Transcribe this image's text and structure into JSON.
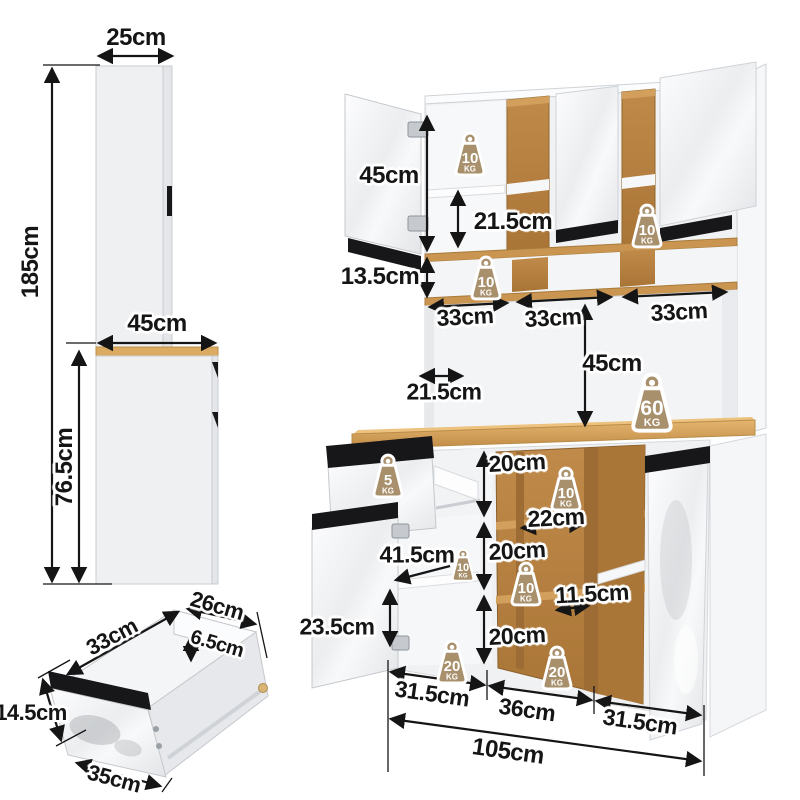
{
  "colors": {
    "oak": "#b5813f",
    "oak_light": "#d2a05c",
    "oak_dark": "#9c6c34",
    "countertop": "#dcab63",
    "panel_white": "#f2f3f5",
    "handle_black": "#17171a",
    "weight_badge": "#a8906c",
    "dimension_text": "#151515"
  },
  "side_view": {
    "top_depth": "25cm",
    "total_height": "185cm",
    "counter_depth": "45cm",
    "base_height": "76.5cm"
  },
  "drawer_view": {
    "depth": "33cm",
    "top_width": "26cm",
    "inner_height": "6.5cm",
    "front_height": "14.5cm",
    "front_width": "35cm"
  },
  "front_view": {
    "upper_door_height": "45cm",
    "upper_shelf_gap": "21.5cm",
    "upper_row_height": "13.5cm",
    "upper_section_width_1": "33cm",
    "upper_section_width_2": "33cm",
    "upper_section_width_3": "33cm",
    "hutch_open_height": "45cm",
    "hutch_shelf_depth": "21.5cm",
    "cubby_gap_1": "20cm",
    "cubby_width": "22cm",
    "cubby_gap_2": "20cm",
    "door_interior_depth": "41.5cm",
    "side_shelf_width": "11.5cm",
    "door_shelf_height": "23.5cm",
    "cubby_gap_3": "20cm",
    "base_section_width_1": "31.5cm",
    "base_section_width_2": "36cm",
    "base_section_width_3": "31.5cm",
    "total_width": "105cm"
  },
  "capacities": {
    "unit": "KG",
    "upper_left_shelf": "10",
    "upper_right_shelf": "10",
    "upper_row_shelf": "10",
    "countertop": "60",
    "drawer": "5",
    "cubby_top": "10",
    "cubby_middle": "10",
    "door_shelf": "10",
    "base_left": "20",
    "base_right": "20"
  }
}
